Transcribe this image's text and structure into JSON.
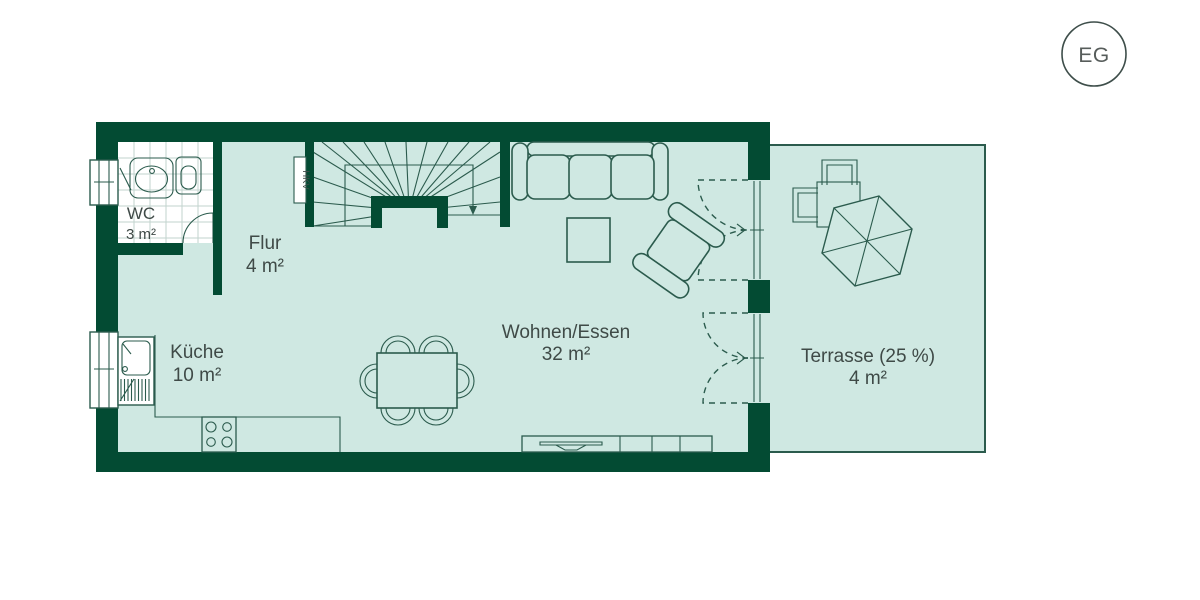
{
  "title": "Grundriss Erdgeschoss",
  "badge": {
    "label": "EG"
  },
  "colors": {
    "wall": "#034b33",
    "floor": "#cfe8e2",
    "line": "#2b5b4d",
    "text": "#3f4a47",
    "tile": "#c2d3cd",
    "badgestroke": "#3e4e4a",
    "badgetext": "#575d5b"
  },
  "rooms": [
    {
      "id": "wc",
      "name": "WC",
      "area": "3 m²"
    },
    {
      "id": "flur",
      "name": "Flur",
      "area": "4 m²"
    },
    {
      "id": "kueche",
      "name": "Küche",
      "area": "10 m²"
    },
    {
      "id": "wohnen",
      "name": "Wohnen/Essen",
      "area": "32 m²"
    },
    {
      "id": "terrasse",
      "name": "Terrasse (25 %)",
      "area": "4 m²"
    }
  ],
  "annotations": {
    "hkv": "HKV"
  },
  "icons": [
    "staircase-icon",
    "stair-direction-arrow-icon",
    "sofa-icon",
    "coffee-table-icon",
    "armchair-icon",
    "dining-table-icon",
    "dining-chair-icon",
    "sideboard-tv-icon",
    "cooktop-icon",
    "kitchen-sink-icon",
    "wc-sink-icon",
    "toilet-icon",
    "door-swing-icon",
    "french-door-swing-icon",
    "window-icon",
    "hkv-cabinet-icon",
    "parasol-icon",
    "terrace-table-icon",
    "terrace-chair-icon"
  ]
}
